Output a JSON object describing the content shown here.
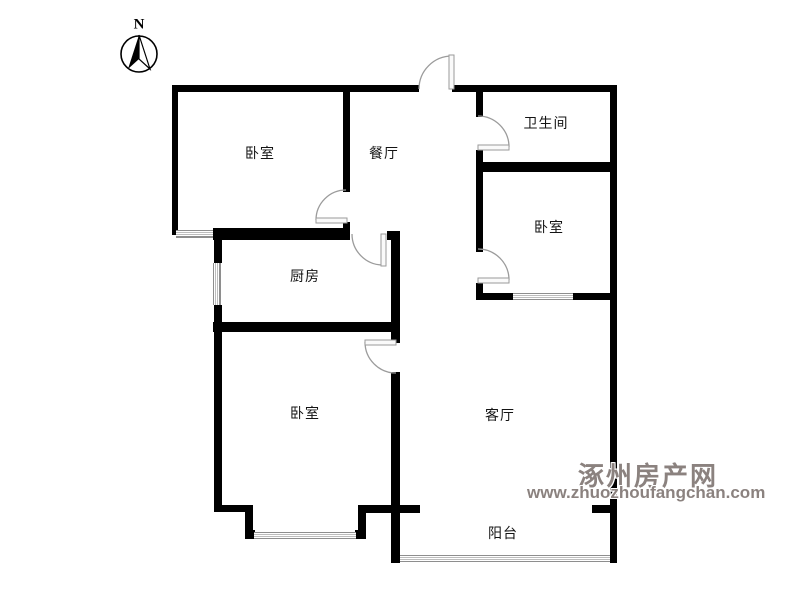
{
  "compass": {
    "label": "N"
  },
  "rooms": [
    {
      "name": "bedroom-northwest",
      "label": "卧室"
    },
    {
      "name": "dining-room",
      "label": "餐厅"
    },
    {
      "name": "bathroom",
      "label": "卫生间"
    },
    {
      "name": "bedroom-east",
      "label": "卧室"
    },
    {
      "name": "kitchen",
      "label": "厨房"
    },
    {
      "name": "bedroom-southwest",
      "label": "卧室"
    },
    {
      "name": "living-room",
      "label": "客厅"
    },
    {
      "name": "balcony",
      "label": "阳台"
    }
  ],
  "watermark": {
    "site_name": "涿州房产网",
    "site_url": "www.zhuozhoufangchan.com"
  },
  "colors": {
    "wall": "#000000",
    "window_line": "#8e8e8e",
    "door_arc": "#9b9b9b",
    "label_text": "#141414",
    "watermark_text": "#8b827f"
  }
}
